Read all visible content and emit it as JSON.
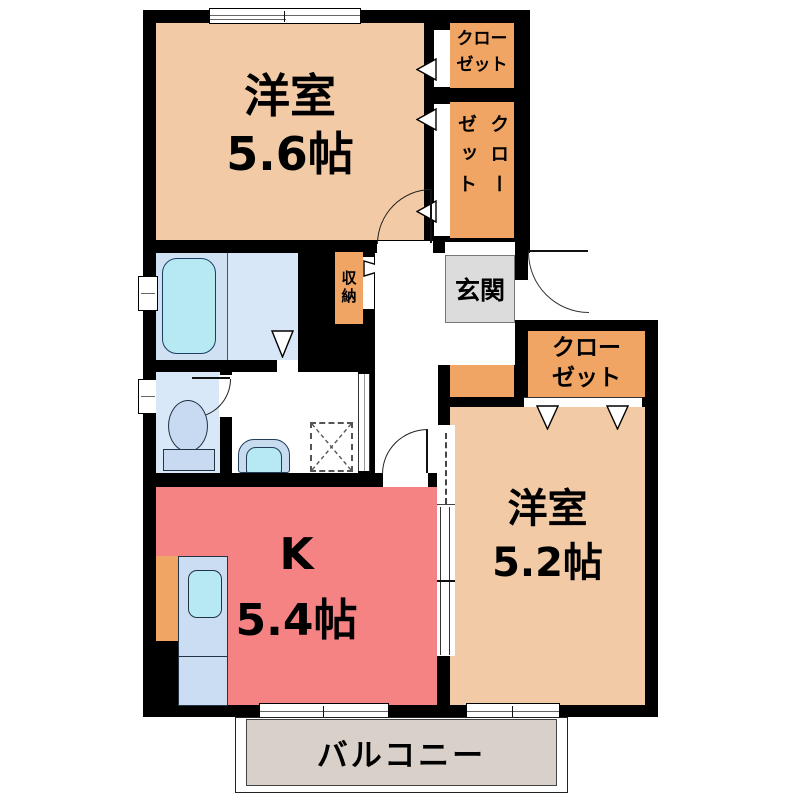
{
  "floorplan": {
    "rooms": {
      "west_room_1": {
        "name": "洋室",
        "size": "5.6帖"
      },
      "west_room_2": {
        "name": "洋室",
        "size": "5.2帖"
      },
      "kitchen": {
        "name": "K",
        "size": "5.4帖"
      },
      "entrance": {
        "label": "玄関"
      },
      "balcony": {
        "label": "バルコニー"
      },
      "storage": {
        "label": "収納"
      }
    },
    "closets": {
      "top": {
        "line1": "クロー",
        "line2": "ゼット"
      },
      "side": {
        "label": "クローゼット"
      },
      "bedroom2": {
        "line1": "クロー",
        "line2": "ゼット"
      }
    },
    "colors": {
      "wall": "#000000",
      "room_peach": "#F2CBA6",
      "closet_orange": "#F0A564",
      "kitchen_red": "#F58383",
      "entrance_gray": "#DCDCDC",
      "balcony_beige": "#D9D1C9",
      "bath_blue": "#CFE1F3",
      "washroom_blue": "#D8E7F7",
      "toilet_blue": "#D9E8F8",
      "fixture_cyan": "#B7E9F3",
      "fixture_blue": "#C8DCF0"
    }
  }
}
